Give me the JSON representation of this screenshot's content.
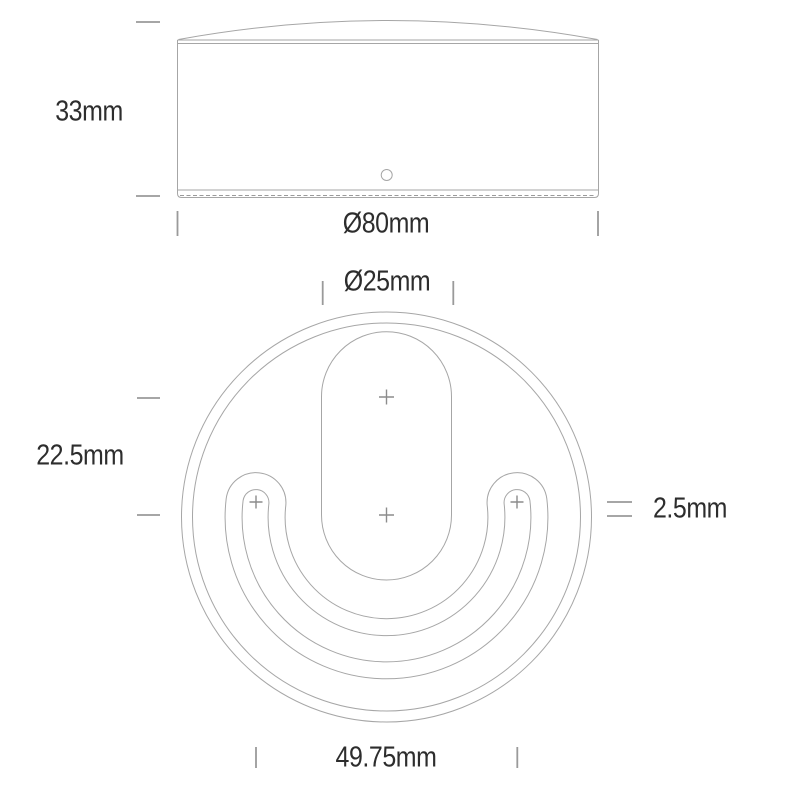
{
  "document": {
    "type": "technical-dimension-drawing",
    "views": [
      "side-view",
      "mounting-plate-top-view"
    ]
  },
  "side_view": {
    "height_label": "33mm",
    "diameter_label": "Ø80mm"
  },
  "top_view": {
    "center_hole_width_label": "Ø25mm",
    "hole_vertical_spacing_label": "22.5mm",
    "slot_width_label": "2.5mm",
    "screw_hole_spacing_label": "49.75mm"
  },
  "colors": {
    "outline_line": "#a6a6a6",
    "tick_mark": "#9a9a9a",
    "cross_mark": "#8c8c8c",
    "label_text": "#2d2d2d",
    "background": "#ffffff"
  }
}
